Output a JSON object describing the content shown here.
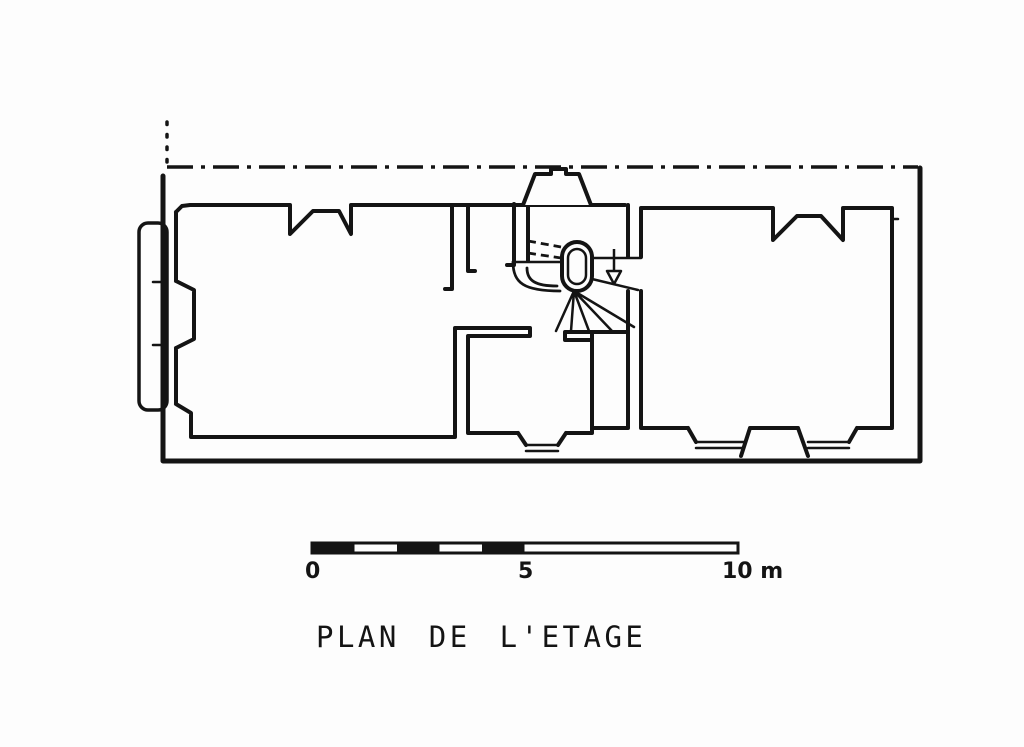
{
  "page": {
    "background": "#fdfdfd",
    "ink": "#141414"
  },
  "drawing": {
    "title": "PLAN DE L'ETAGE",
    "kind": "architectural floor plan of the upper storey, black ink line drawing",
    "stair_direction_arrow": "down",
    "axis_line_style": "dash-dot",
    "setback_line_style": "dotted"
  },
  "scale_bar": {
    "label_start": "0",
    "label_mid": "5",
    "label_end": "10 m",
    "total_meters": 10,
    "major_ticks_m": [
      0,
      5,
      10
    ]
  }
}
